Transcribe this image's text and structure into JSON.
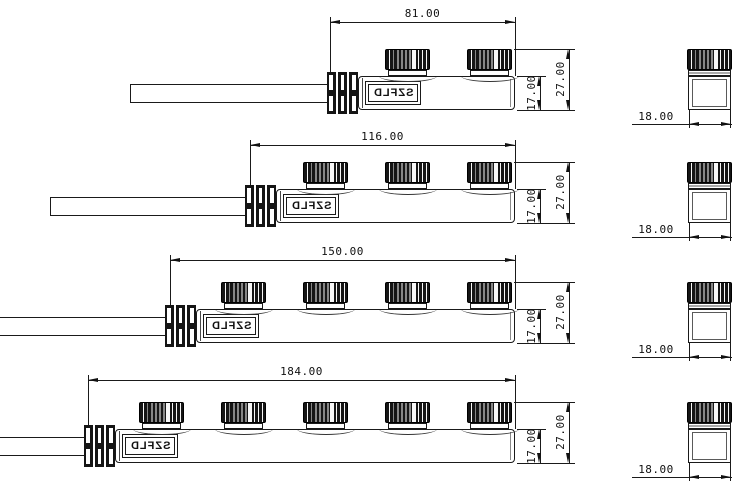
{
  "drawing": {
    "brand": "SZFLD",
    "type": "multi-port distribution connector blocks, 4 length variants with side and end views",
    "colors": {
      "line": "#1a1a1a",
      "cap_fill": "#151515",
      "background": "#ffffff"
    },
    "rows": [
      {
        "ports": 2,
        "length": "81.00",
        "body_height": "17.00",
        "total_height": "27.00",
        "end_width": "18.00"
      },
      {
        "ports": 3,
        "length": "116.00",
        "body_height": "17.00",
        "total_height": "27.00",
        "end_width": "18.00"
      },
      {
        "ports": 4,
        "length": "150.00",
        "body_height": "17.00",
        "total_height": "27.00",
        "end_width": "18.00"
      },
      {
        "ports": 5,
        "length": "184.00",
        "body_height": "17.00",
        "total_height": "27.00",
        "end_width": "18.00"
      }
    ]
  }
}
